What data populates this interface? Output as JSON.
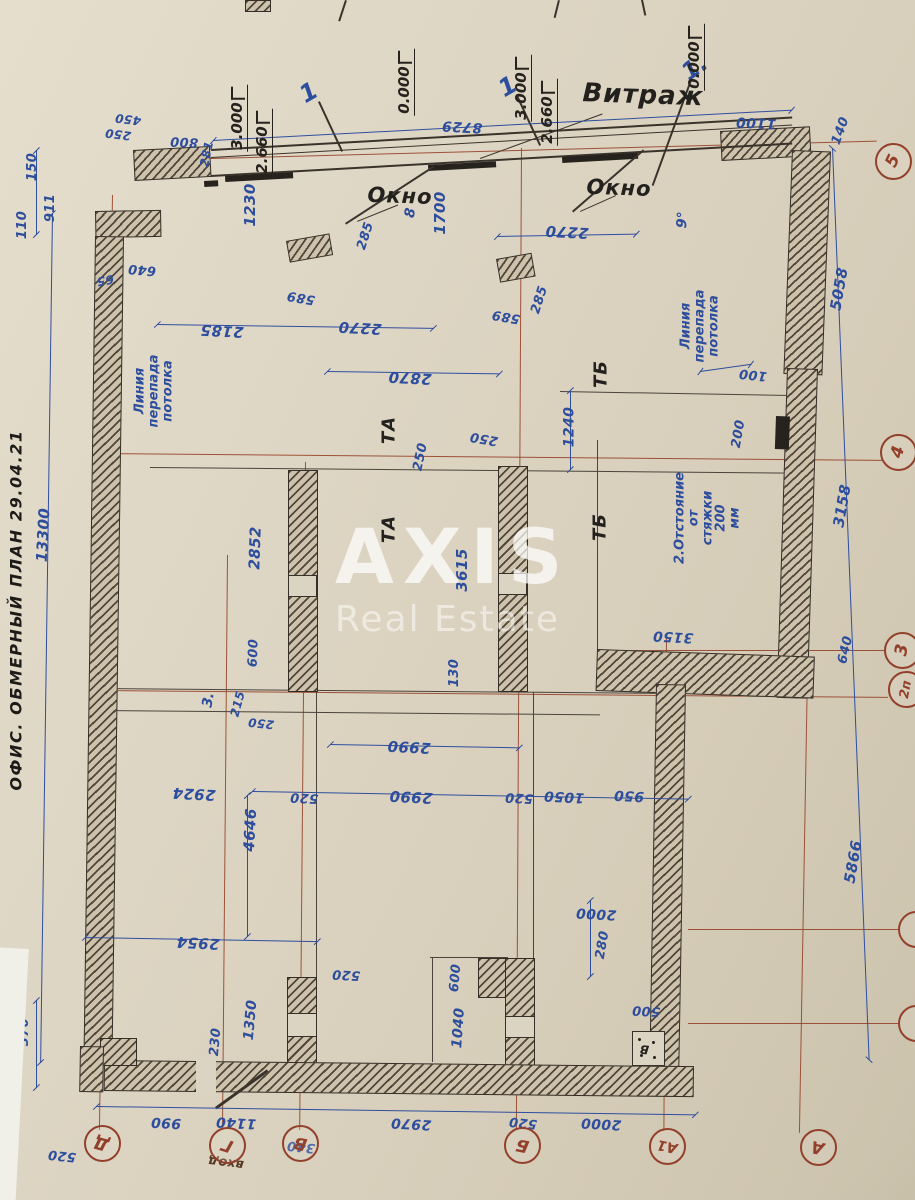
{
  "document": {
    "type": "measurement floor plan photo",
    "title": "ОФИС. ОБМЕРНЫЙ ПЛАН 29.04.21"
  },
  "watermark": {
    "line1": "AXIS",
    "line2": "Real Estate"
  },
  "colors": {
    "paper": "#dcd4c2",
    "ink_blue": "#2d4d9d",
    "ink_black": "#26221d",
    "axis_brown": "#93402b"
  },
  "axis_circles": [
    {
      "t": "Д",
      "x": 102,
      "y": 1143,
      "r": 195
    },
    {
      "t": "Г",
      "x": 227,
      "y": 1145,
      "r": 198
    },
    {
      "t": "В",
      "x": 300,
      "y": 1143,
      "r": 192
    },
    {
      "t": "Б",
      "x": 522,
      "y": 1145,
      "r": 192
    },
    {
      "t": "А1",
      "x": 667,
      "y": 1146,
      "r": 192,
      "s": 14
    },
    {
      "t": "А",
      "x": 818,
      "y": 1147,
      "r": 192
    },
    {
      "t": "5",
      "x": 893,
      "y": 161,
      "r": -65
    },
    {
      "t": "4",
      "x": 898,
      "y": 452,
      "r": -75
    },
    {
      "t": "3",
      "x": 902,
      "y": 650,
      "r": -80
    },
    {
      "t": "2п",
      "x": 906,
      "y": 689,
      "r": -80,
      "s": 13
    },
    {
      "t": "",
      "x": 916,
      "y": 929,
      "r": 0
    },
    {
      "t": "",
      "x": 916,
      "y": 1023,
      "r": 0
    }
  ],
  "elevation_marks": [
    {
      "t": "3.000",
      "x": 238,
      "y": 118
    },
    {
      "t": "2.660",
      "x": 263,
      "y": 142
    },
    {
      "t": "0.000",
      "x": 405,
      "y": 82
    },
    {
      "t": "3.000",
      "x": 522,
      "y": 88
    },
    {
      "t": "2.660",
      "x": 548,
      "y": 112
    },
    {
      "t": "0.000",
      "x": 695,
      "y": 57
    }
  ],
  "annotations": [
    {
      "t": "ОФИС. ОБМЕРНЫЙ ПЛАН 29.04.21",
      "x": 17,
      "y": 610,
      "r": -90,
      "c": "ttl",
      "s": 16,
      "n": "plan-title"
    },
    {
      "t": "13300",
      "x": 44,
      "y": 535,
      "r": -87,
      "c": "dim",
      "s": 15
    },
    {
      "t": "Витраж",
      "x": 643,
      "y": 96,
      "r": 2,
      "c": "lbl",
      "s": 26,
      "n": "vitrage-label"
    },
    {
      "t": "Окно",
      "x": 400,
      "y": 196,
      "r": 2,
      "c": "lbl",
      "s": 21,
      "n": "window-label"
    },
    {
      "t": "Окно",
      "x": 619,
      "y": 188,
      "r": 2,
      "c": "lbl",
      "s": 21,
      "n": "window-label"
    },
    {
      "t": "ТА",
      "x": 389,
      "y": 430,
      "r": -90,
      "c": "lbl",
      "s": 18,
      "n": "ceiling-mark-ta"
    },
    {
      "t": "ТА",
      "x": 389,
      "y": 529,
      "r": -90,
      "c": "lbl",
      "s": 18,
      "n": "ceiling-mark-ta"
    },
    {
      "t": "ТБ",
      "x": 601,
      "y": 374,
      "r": -90,
      "c": "lbl",
      "s": 18,
      "n": "ceiling-mark-tb"
    },
    {
      "t": "ТБ",
      "x": 600,
      "y": 527,
      "r": -90,
      "c": "lbl",
      "s": 18,
      "n": "ceiling-mark-tb"
    },
    {
      "t": "Линия\nперепада\nпотолка",
      "x": 154,
      "y": 391,
      "r": -90,
      "c": "note",
      "s": 13,
      "n": "ceiling-drop-note"
    },
    {
      "t": "Линия\nперепада\nпотолка",
      "x": 700,
      "y": 326,
      "r": -90,
      "c": "note",
      "s": 13,
      "n": "ceiling-drop-note"
    },
    {
      "t": "2.Отстояние\nот\nстяжки\n200\nмм",
      "x": 708,
      "y": 518,
      "r": -90,
      "c": "note",
      "s": 13,
      "n": "screed-offset-note"
    },
    {
      "t": "вход",
      "x": 226,
      "y": 1162,
      "r": 187,
      "c": "ent",
      "s": 13,
      "n": "entrance-label"
    },
    {
      "t": "В",
      "x": 644,
      "y": 1049,
      "r": 186,
      "c": "lbl",
      "s": 12,
      "n": "switchboard-label"
    },
    {
      "t": "1",
      "x": 309,
      "y": 93,
      "r": -30,
      "c": "call",
      "s": 24,
      "n": "callout-1"
    },
    {
      "t": "1",
      "x": 508,
      "y": 87,
      "r": -30,
      "c": "call",
      "s": 24,
      "n": "callout-1"
    },
    {
      "t": "1.",
      "x": 695,
      "y": 68,
      "r": -35,
      "c": "call",
      "s": 24,
      "n": "callout-1"
    },
    {
      "t": "3.",
      "x": 209,
      "y": 700,
      "r": -80,
      "c": "call",
      "s": 14,
      "n": "callout-3"
    },
    {
      "t": "8",
      "x": 411,
      "y": 213,
      "r": -80,
      "c": "call",
      "s": 14,
      "n": "callout-8"
    },
    {
      "t": "9°",
      "x": 683,
      "y": 220,
      "r": -85,
      "c": "call",
      "s": 14,
      "n": "callout-9deg"
    },
    {
      "t": "450",
      "x": 128,
      "y": 119,
      "r": 187,
      "c": "dim",
      "s": 12
    },
    {
      "t": "250",
      "x": 118,
      "y": 134,
      "r": 187,
      "c": "dim",
      "s": 12
    },
    {
      "t": "800",
      "x": 184,
      "y": 141,
      "r": 183,
      "c": "dim",
      "s": 13
    },
    {
      "t": "281",
      "x": 207,
      "y": 154,
      "r": -78,
      "c": "dim",
      "s": 12
    },
    {
      "t": "150",
      "x": 33,
      "y": 167,
      "r": -90,
      "c": "dim",
      "s": 13
    },
    {
      "t": "911",
      "x": 51,
      "y": 208,
      "r": -90,
      "c": "dim",
      "s": 13
    },
    {
      "t": "110",
      "x": 23,
      "y": 225,
      "r": -90,
      "c": "dim",
      "s": 13
    },
    {
      "t": "65",
      "x": 105,
      "y": 280,
      "r": 170,
      "c": "dim",
      "s": 12
    },
    {
      "t": "640",
      "x": 142,
      "y": 269,
      "r": 185,
      "c": "dim",
      "s": 13
    },
    {
      "t": "1230",
      "x": 251,
      "y": 205,
      "r": -90,
      "c": "dim",
      "s": 15
    },
    {
      "t": "285",
      "x": 366,
      "y": 236,
      "r": -72,
      "c": "dim",
      "s": 13
    },
    {
      "t": "1700",
      "x": 441,
      "y": 213,
      "r": -90,
      "c": "dim",
      "s": 15
    },
    {
      "t": "589",
      "x": 301,
      "y": 297,
      "r": 190,
      "c": "dim",
      "s": 13
    },
    {
      "t": "2185",
      "x": 222,
      "y": 330,
      "r": 183,
      "c": "dim",
      "s": 15
    },
    {
      "t": "2270",
      "x": 360,
      "y": 327,
      "r": 183,
      "c": "dim",
      "s": 15
    },
    {
      "t": "2870",
      "x": 410,
      "y": 377,
      "r": 183,
      "c": "dim",
      "s": 15
    },
    {
      "t": "285",
      "x": 540,
      "y": 300,
      "r": -72,
      "c": "dim",
      "s": 13
    },
    {
      "t": "589",
      "x": 506,
      "y": 316,
      "r": 190,
      "c": "dim",
      "s": 13
    },
    {
      "t": "2270",
      "x": 567,
      "y": 231,
      "r": 183,
      "c": "dim",
      "s": 15
    },
    {
      "t": "8729",
      "x": 462,
      "y": 126,
      "r": 183,
      "c": "dim",
      "s": 14
    },
    {
      "t": "1100",
      "x": 756,
      "y": 122,
      "r": 183,
      "c": "dim",
      "s": 14
    },
    {
      "t": "140",
      "x": 841,
      "y": 131,
      "r": -70,
      "c": "dim",
      "s": 13
    },
    {
      "t": "5058",
      "x": 840,
      "y": 289,
      "r": -80,
      "c": "dim",
      "s": 15
    },
    {
      "t": "3158",
      "x": 843,
      "y": 506,
      "r": -80,
      "c": "dim",
      "s": 15
    },
    {
      "t": "640",
      "x": 846,
      "y": 650,
      "r": -77,
      "c": "dim",
      "s": 13
    },
    {
      "t": "5866",
      "x": 854,
      "y": 862,
      "r": -80,
      "c": "dim",
      "s": 15
    },
    {
      "t": "1240",
      "x": 570,
      "y": 427,
      "r": -90,
      "c": "dim",
      "s": 14
    },
    {
      "t": "100",
      "x": 753,
      "y": 374,
      "r": 186,
      "c": "dim",
      "s": 13
    },
    {
      "t": "200",
      "x": 739,
      "y": 434,
      "r": -80,
      "c": "dim",
      "s": 13
    },
    {
      "t": "250",
      "x": 421,
      "y": 457,
      "r": -78,
      "c": "dim",
      "s": 13
    },
    {
      "t": "250",
      "x": 484,
      "y": 438,
      "r": 190,
      "c": "dim",
      "s": 13
    },
    {
      "t": "2852",
      "x": 256,
      "y": 548,
      "r": -88,
      "c": "dim",
      "s": 15
    },
    {
      "t": "3615",
      "x": 463,
      "y": 570,
      "r": -90,
      "c": "dim",
      "s": 15
    },
    {
      "t": "130",
      "x": 455,
      "y": 673,
      "r": -90,
      "c": "dim",
      "s": 13
    },
    {
      "t": "600",
      "x": 254,
      "y": 653,
      "r": -88,
      "c": "dim",
      "s": 13
    },
    {
      "t": "215",
      "x": 238,
      "y": 704,
      "r": -75,
      "c": "dim",
      "s": 12
    },
    {
      "t": "250",
      "x": 261,
      "y": 723,
      "r": 186,
      "c": "dim",
      "s": 12
    },
    {
      "t": "3150",
      "x": 673,
      "y": 636,
      "r": 183,
      "c": "dim",
      "s": 14
    },
    {
      "t": "2924",
      "x": 194,
      "y": 793,
      "r": 183,
      "c": "dim",
      "s": 15
    },
    {
      "t": "4646",
      "x": 251,
      "y": 830,
      "r": -87,
      "c": "dim",
      "s": 15
    },
    {
      "t": "520",
      "x": 304,
      "y": 797,
      "r": 183,
      "c": "dim",
      "s": 13
    },
    {
      "t": "2990",
      "x": 409,
      "y": 746,
      "r": 183,
      "c": "dim",
      "s": 15
    },
    {
      "t": "2990",
      "x": 411,
      "y": 796,
      "r": 183,
      "c": "dim",
      "s": 15
    },
    {
      "t": "520",
      "x": 519,
      "y": 797,
      "r": 183,
      "c": "dim",
      "s": 13
    },
    {
      "t": "1050",
      "x": 564,
      "y": 796,
      "r": 183,
      "c": "dim",
      "s": 14
    },
    {
      "t": "950",
      "x": 629,
      "y": 795,
      "r": 183,
      "c": "dim",
      "s": 14
    },
    {
      "t": "2954",
      "x": 198,
      "y": 942,
      "r": 183,
      "c": "dim",
      "s": 15
    },
    {
      "t": "520",
      "x": 346,
      "y": 974,
      "r": 183,
      "c": "dim",
      "s": 13
    },
    {
      "t": "1350",
      "x": 251,
      "y": 1020,
      "r": -85,
      "c": "dim",
      "s": 14
    },
    {
      "t": "230",
      "x": 216,
      "y": 1042,
      "r": -85,
      "c": "dim",
      "s": 13
    },
    {
      "t": "370",
      "x": 25,
      "y": 1032,
      "r": -90,
      "c": "dim",
      "s": 13
    },
    {
      "t": "520",
      "x": 62,
      "y": 1155,
      "r": 186,
      "c": "dim",
      "s": 13
    },
    {
      "t": "990",
      "x": 166,
      "y": 1122,
      "r": 183,
      "c": "dim",
      "s": 14
    },
    {
      "t": "1140",
      "x": 236,
      "y": 1122,
      "r": 183,
      "c": "dim",
      "s": 14
    },
    {
      "t": "2970",
      "x": 411,
      "y": 1123,
      "r": 183,
      "c": "dim",
      "s": 14
    },
    {
      "t": "520",
      "x": 523,
      "y": 1122,
      "r": 186,
      "c": "dim",
      "s": 13
    },
    {
      "t": "2000",
      "x": 601,
      "y": 1123,
      "r": 183,
      "c": "dim",
      "s": 14
    },
    {
      "t": "340",
      "x": 301,
      "y": 1146,
      "r": 186,
      "c": "dim",
      "s": 13
    },
    {
      "t": "2000",
      "x": 596,
      "y": 913,
      "r": 183,
      "c": "dim",
      "s": 14
    },
    {
      "t": "280",
      "x": 603,
      "y": 945,
      "r": -80,
      "c": "dim",
      "s": 13
    },
    {
      "t": "600",
      "x": 456,
      "y": 978,
      "r": -85,
      "c": "dim",
      "s": 13
    },
    {
      "t": "1040",
      "x": 459,
      "y": 1028,
      "r": -86,
      "c": "dim",
      "s": 14
    },
    {
      "t": "500",
      "x": 646,
      "y": 1010,
      "r": 183,
      "c": "dim",
      "s": 13
    }
  ]
}
